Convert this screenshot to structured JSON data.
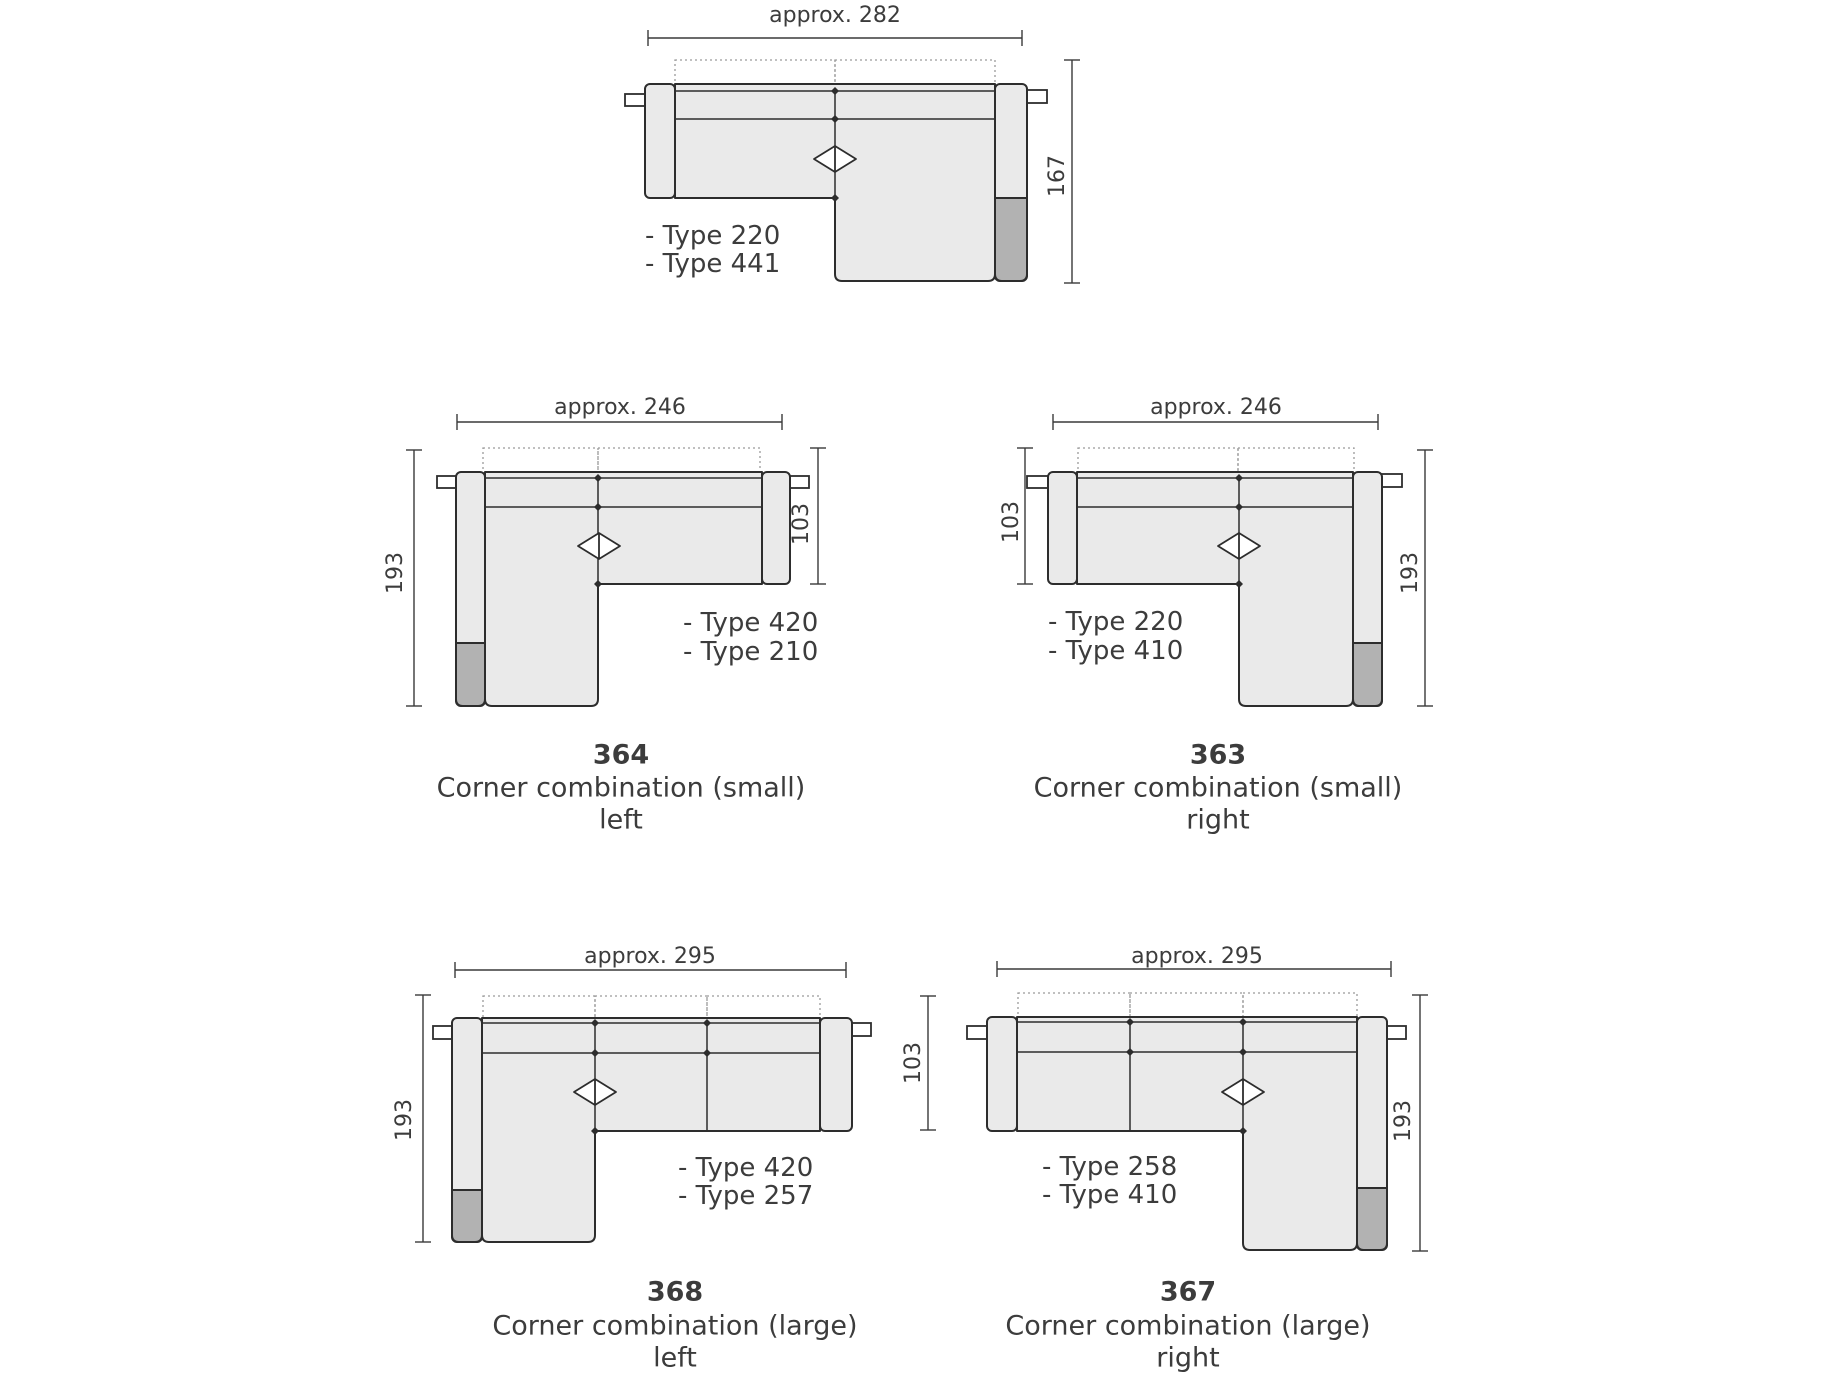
{
  "background": "#ffffff",
  "colors": {
    "sofa_fill": "#eaeaea",
    "sofa_accent_fill": "#b2b2b2",
    "outline": "#2d2d2d",
    "dim_line": "#3a3a3a",
    "dotted_line": "#9a9a9a",
    "tab_fill": "#ffffff",
    "text": "#3c3c3c"
  },
  "icons": {
    "seam_marker": "split-diamond",
    "seam_dot": "small-filled-diamond"
  },
  "diagrams": {
    "top": {
      "width_dim": "approx. 282",
      "height_dim": "167",
      "types": [
        "- Type 220",
        "- Type 441"
      ]
    },
    "small_left": {
      "code": "364",
      "name": "Corner combination (small)",
      "orientation": "left",
      "width_dim": "approx. 246",
      "height_dim": "193",
      "depth_dim": "103",
      "types": [
        "- Type 420",
        "- Type 210"
      ]
    },
    "small_right": {
      "code": "363",
      "name": "Corner combination (small)",
      "orientation": "right",
      "width_dim": "approx. 246",
      "height_dim": "193",
      "depth_dim": "103",
      "types": [
        "- Type 220",
        "- Type 410"
      ]
    },
    "large_left": {
      "code": "368",
      "name": "Corner combination (large)",
      "orientation": "left",
      "width_dim": "approx. 295",
      "height_dim": "193",
      "types": [
        "- Type 420",
        "- Type 257"
      ]
    },
    "large_right": {
      "code": "367",
      "name": "Corner combination (large)",
      "orientation": "right",
      "width_dim": "approx. 295",
      "height_dim": "193",
      "depth_dim": "103",
      "types": [
        "- Type 258",
        "- Type 410"
      ]
    }
  }
}
